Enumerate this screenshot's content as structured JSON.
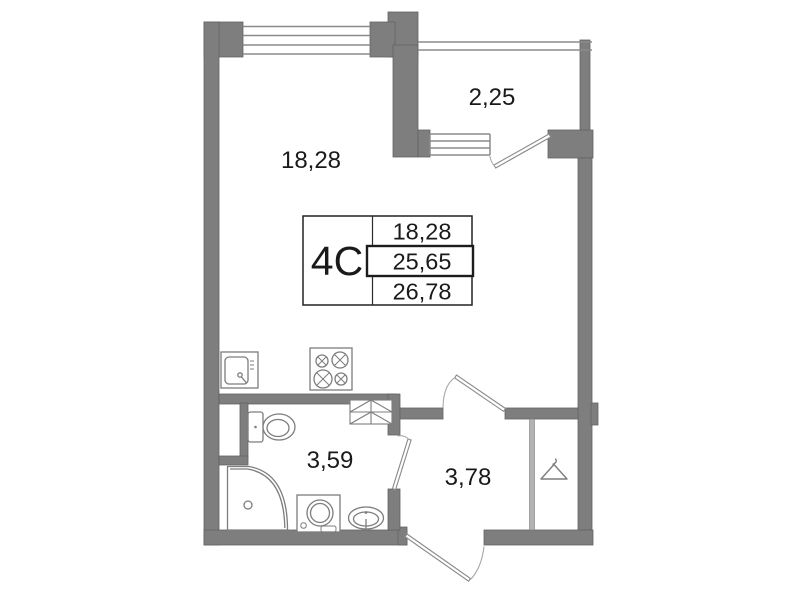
{
  "plan": {
    "kind": "apartment-floor-plan",
    "unit_type": "studio"
  },
  "colors": {
    "wall": "#7e7e7e",
    "wall_edge": "#636363",
    "line": "#8b8b8b",
    "fixture": "#7d7d7d",
    "arc": "#a9a9a9",
    "text": "#1a1a1a",
    "table_border": "#222222",
    "divider_fill": "#b3b3b3"
  },
  "rooms": {
    "main": {
      "name": "living-kitchen",
      "area": "18,28"
    },
    "balcony": {
      "name": "balcony",
      "area": "2,25"
    },
    "bathroom": {
      "name": "bathroom",
      "area": "3,59"
    },
    "hallway": {
      "name": "hallway",
      "area": "3,78"
    }
  },
  "info_table": {
    "type_label": "4С",
    "rows": [
      {
        "value": "18,28"
      },
      {
        "value": "25,65"
      },
      {
        "value": "26,78"
      }
    ],
    "highlighted_row_index": 1
  },
  "fixtures": [
    "kitchen-sink",
    "stove-4-burner",
    "ventilation-shaft",
    "toilet",
    "corner-shower",
    "washing-machine",
    "pedestal-sink",
    "clothes-hanger-wardrobe"
  ]
}
